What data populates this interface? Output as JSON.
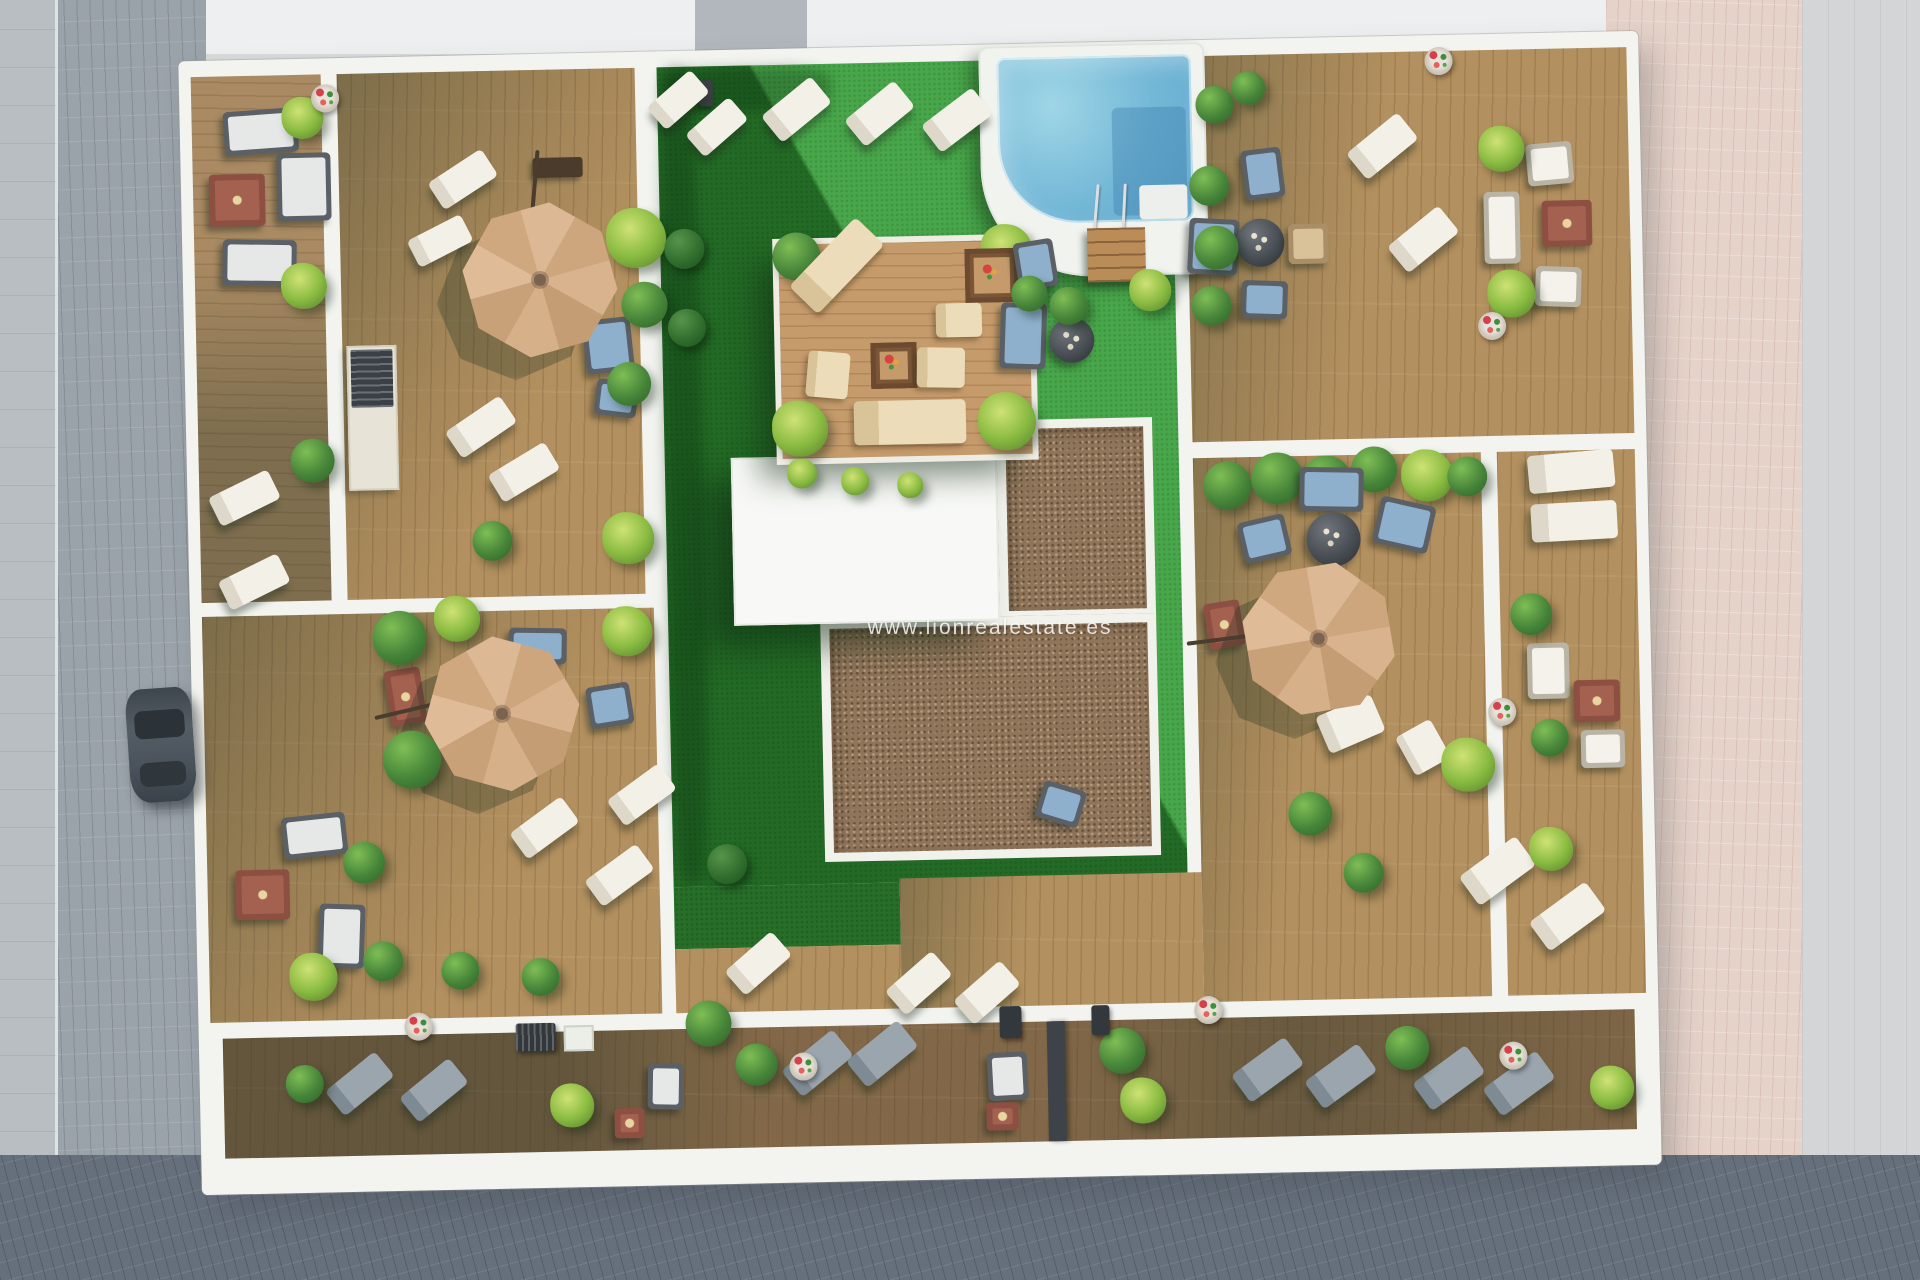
{
  "scene": {
    "type": "aerial-3d-architectural-render",
    "subject": "Top-down render of residential building terraces with communal pool garden",
    "watermark": "www.lionrealestate.es",
    "features": [
      "swimming-pool",
      "lawn-courtyard",
      "wood-deck-terraces",
      "parasols",
      "sun-loungers",
      "outdoor-sofas",
      "fire-tables",
      "round-tables",
      "planters",
      "flower-pots",
      "perimeter-balcony",
      "cobblestone-street",
      "parked-car",
      "gravel-roof",
      "white-roof-structure",
      "pool-ladder",
      "pool-steps",
      "bbq-grills",
      "outdoor-kitchen-counter"
    ],
    "counts": {
      "parasols": 3,
      "pools": 1,
      "parked_cars": 1,
      "fire_tables": 8
    },
    "palette": {
      "lawn_bright": "#3aa03c",
      "lawn_shadow": "#276f29",
      "deck_wood": "#b3905f",
      "deck_dark": "#8d6f4c",
      "walls_white": "#f3f4f0",
      "pool_water": "#74b8d7",
      "parasol_tan": "#d4ae87",
      "gravel_brown": "#8f755a",
      "pavement_left_grey": "#9aa2aa",
      "pavement_bottom_dark": "#66707c",
      "pavement_right_pink": "#e5d2c8",
      "fire_table_red": "#a5614f",
      "cushion_blue": "#8fb0cd",
      "car_grey": "#49525a"
    }
  }
}
